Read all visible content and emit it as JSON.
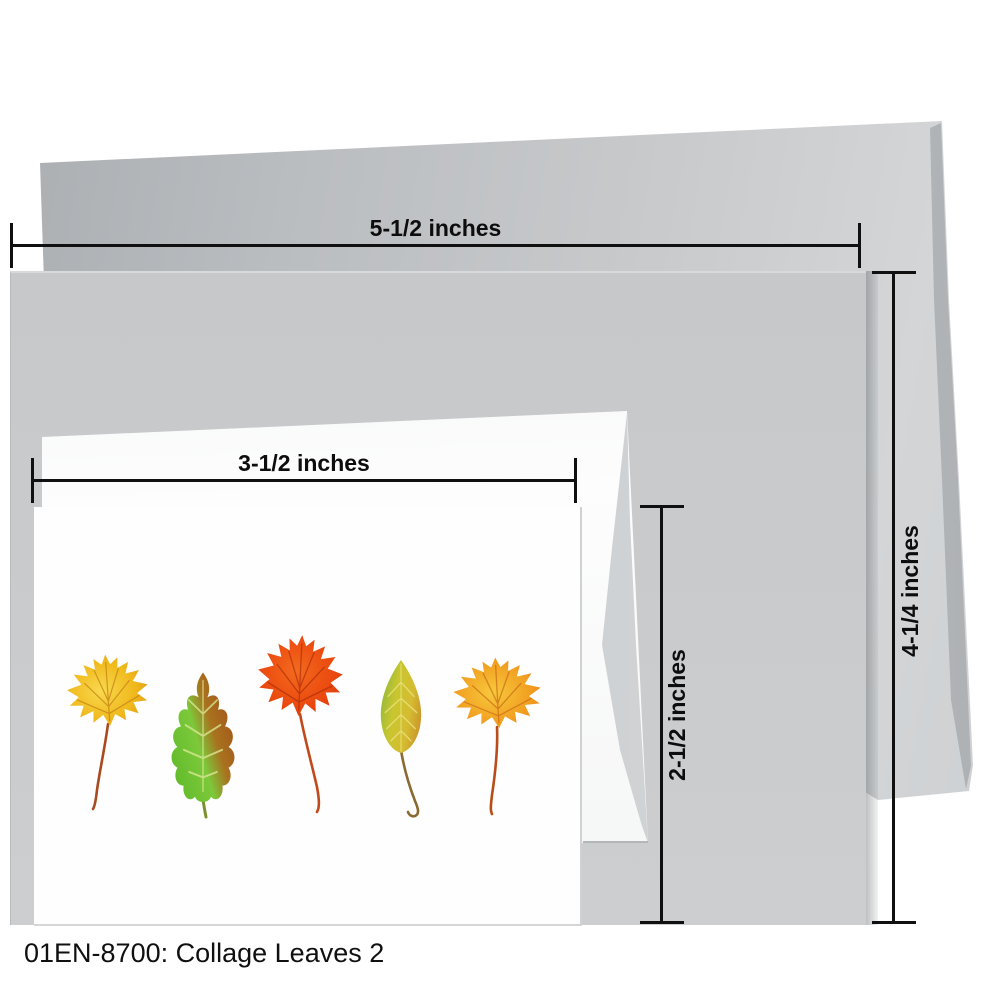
{
  "product": {
    "sku": "01EN-8700",
    "title": "Collage Leaves 2",
    "caption": "01EN-8700: Collage Leaves 2"
  },
  "measurements": {
    "envelope_width_label": "5-1/2 inches",
    "envelope_height_label": "4-1/4 inches",
    "card_width_label": "3-1/2 inches",
    "card_height_label": "2-1/2 inches"
  },
  "scene": {
    "background_color": "#ffffff",
    "large_envelope_color": "#c3c6c8",
    "large_card_color": "#c8cacc",
    "small_envelope_color": "#f7f8f8",
    "small_card_color": "#fefefe",
    "measure_line_color": "#101010",
    "caption_color": "#101010"
  },
  "leaves": [
    {
      "name": "maple-leaf-yellow",
      "primary_color": "#f0b91c"
    },
    {
      "name": "oak-leaf-green-brown",
      "primary_color": "#74c138"
    },
    {
      "name": "maple-leaf-red-orange",
      "primary_color": "#ea480e"
    },
    {
      "name": "birch-leaf-yellow-green",
      "primary_color": "#c9c32f"
    },
    {
      "name": "maple-leaf-orange",
      "primary_color": "#f19e20"
    }
  ]
}
